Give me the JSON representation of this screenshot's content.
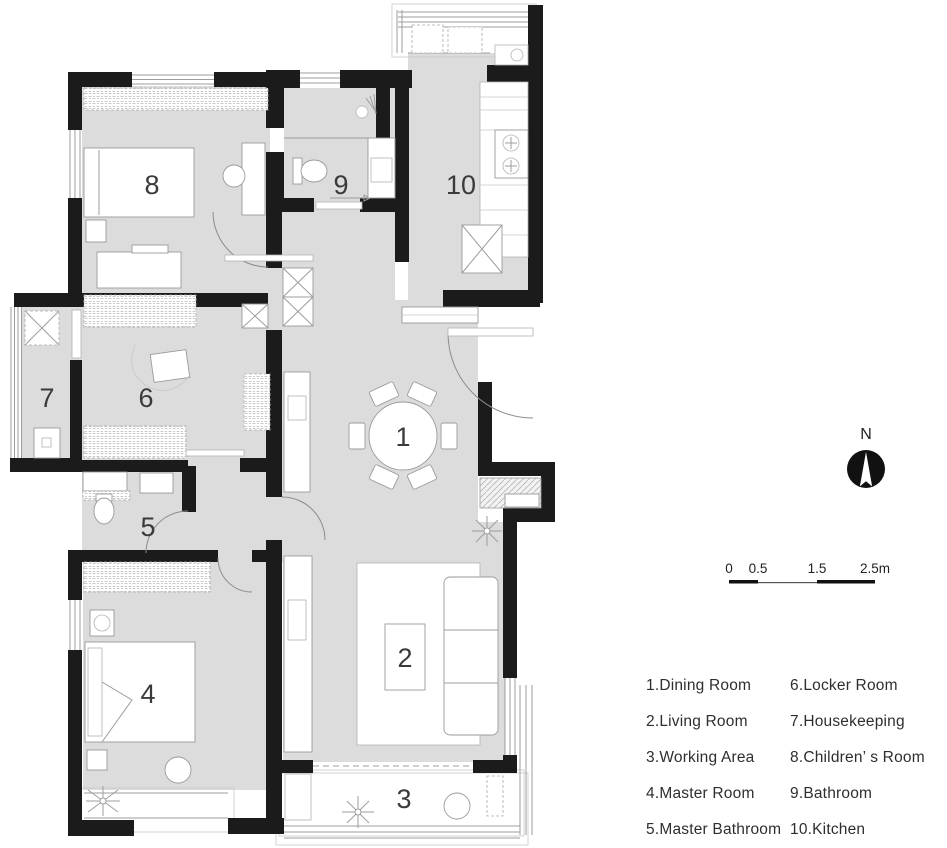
{
  "plan": {
    "room_labels": [
      {
        "number": "1",
        "name": "Dining Room"
      },
      {
        "number": "2",
        "name": "Living Room"
      },
      {
        "number": "3",
        "name": "Working Area"
      },
      {
        "number": "4",
        "name": "Master Room"
      },
      {
        "number": "5",
        "name": "Master Bathroom"
      },
      {
        "number": "6",
        "name": "Locker Room"
      },
      {
        "number": "7",
        "name": "Housekeeping"
      },
      {
        "number": "8",
        "name": "Children’s Room"
      },
      {
        "number": "9",
        "name": "Bathroom"
      },
      {
        "number": "10",
        "name": "Kitchen"
      }
    ],
    "colors": {
      "floor": "#dcdcdc",
      "wall": "#1b1b1b"
    }
  },
  "compass": {
    "label": "N"
  },
  "scale_bar": {
    "labels": [
      "0",
      "0.5",
      "1.5",
      "2.5m"
    ]
  },
  "legend": {
    "column1": [
      "1.Dining Room",
      "2.Living Room",
      "3.Working Area",
      "4.Master Room",
      "5.Master Bathroom"
    ],
    "column2": [
      "6.Locker Room",
      "7.Housekeeping",
      "8.Children’ s Room",
      "9.Bathroom",
      "10.Kitchen"
    ]
  }
}
